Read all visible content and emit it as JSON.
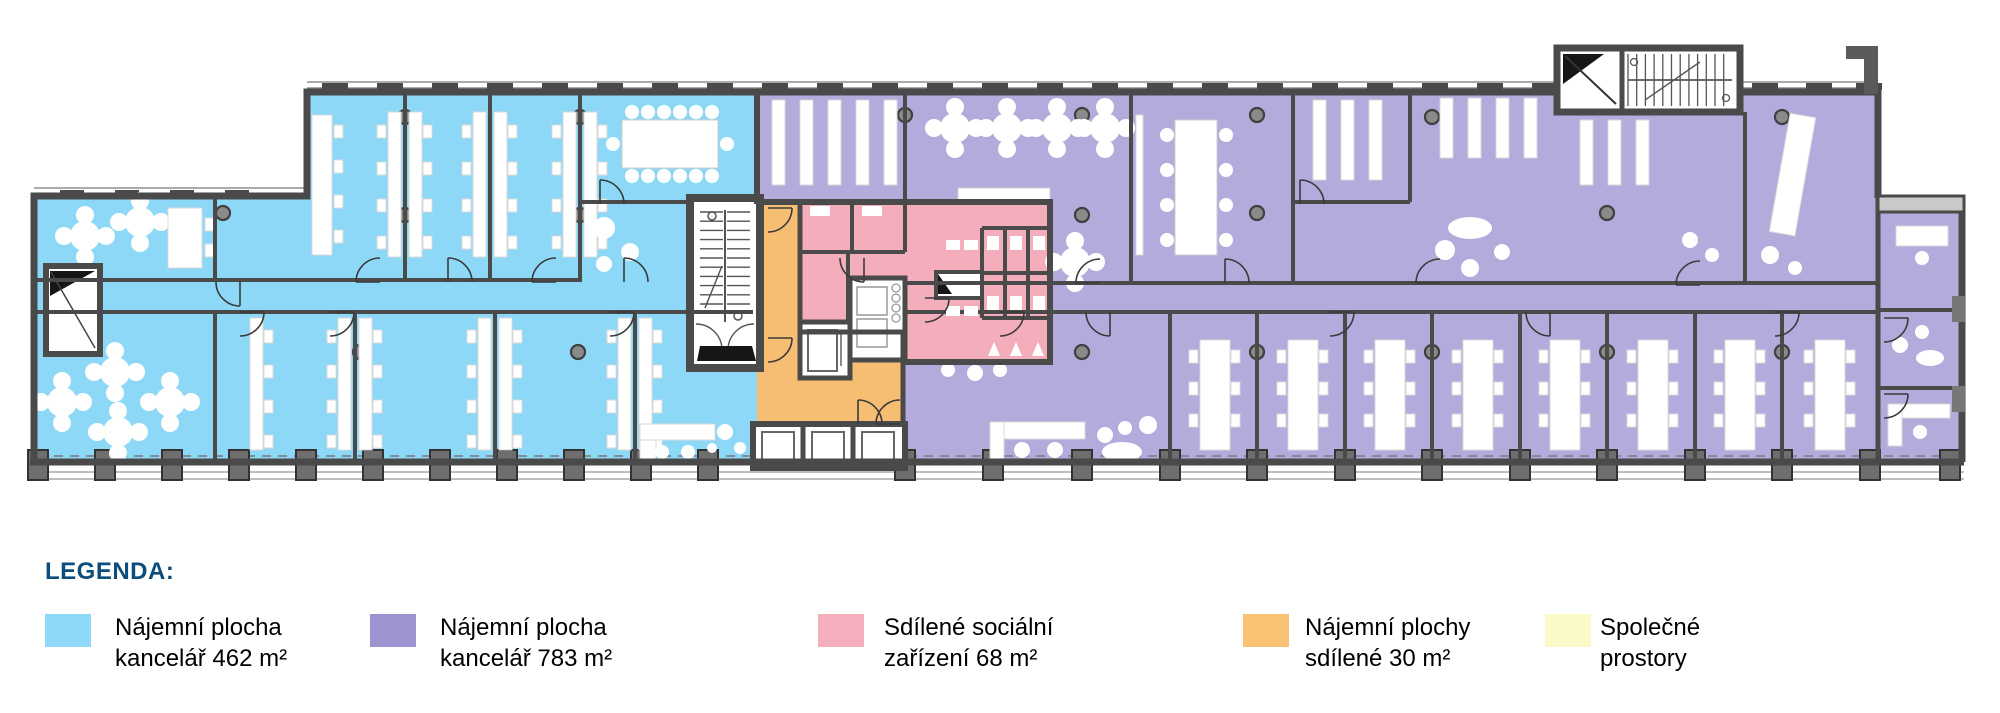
{
  "legend": {
    "title": "LEGENDA:",
    "items": [
      {
        "name": "offices-462",
        "color": "#8FD9F8",
        "line1": "Nájemní plocha",
        "line2": "kancelář 462 m²"
      },
      {
        "name": "offices-783",
        "color": "#9C93CF",
        "line1": "Nájemní plocha",
        "line2": "kancelář 783 m²"
      },
      {
        "name": "shared-sanitary-68",
        "color": "#F5AEBB",
        "line1": "Sdílené sociální",
        "line2": "zařízení 68 m²"
      },
      {
        "name": "shared-rentable-30",
        "color": "#F8C274",
        "line1": "Nájemní plochy",
        "line2": "sdílené 30 m²"
      },
      {
        "name": "common-areas",
        "color": "#FAFAC8",
        "line1": "Společné",
        "line2": "prostory"
      }
    ]
  },
  "colors": {
    "text": "#0D4D7C",
    "wall": "#4A4A4A",
    "zone_blue": "#8ED8F7",
    "zone_purple": "#B4ABDC",
    "zone_pink": "#F4ADBA",
    "zone_orange": "#F6BE72",
    "core_white": "#FFFFFF",
    "pillar": "#8A8A8A",
    "facade": "#6E6E6E"
  }
}
